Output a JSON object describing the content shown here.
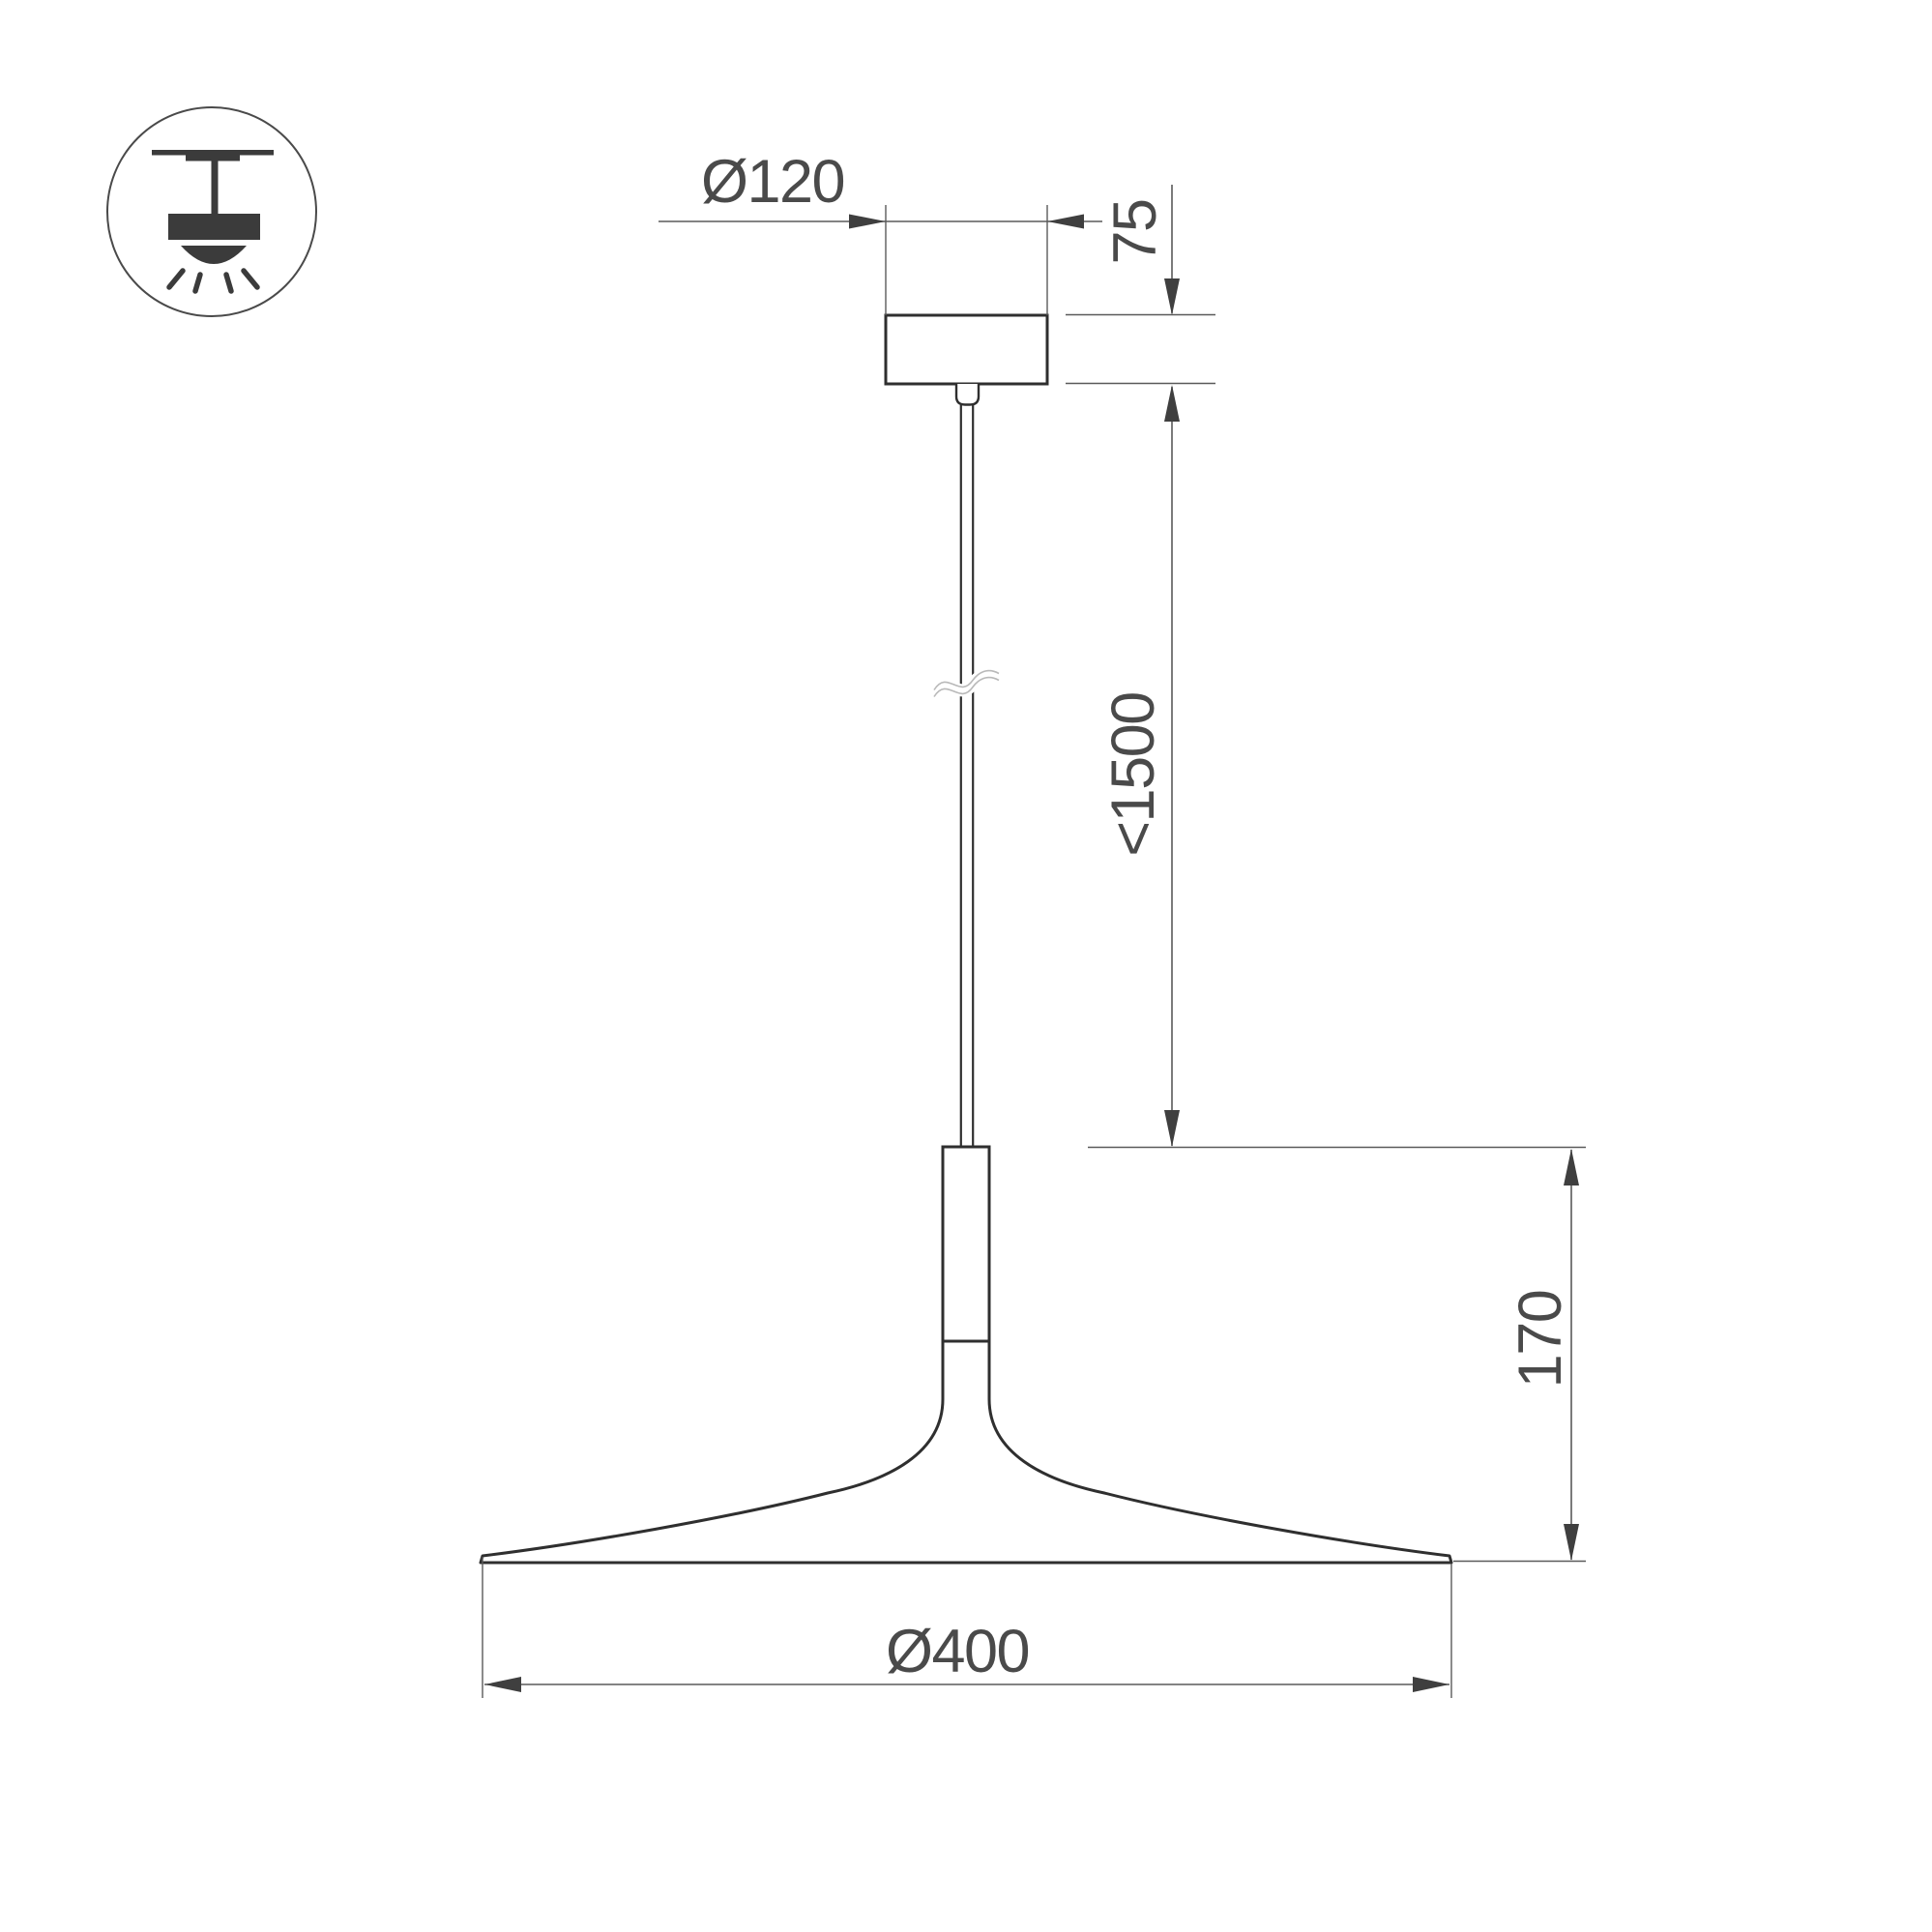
{
  "drawing": {
    "type": "pendant-lamp-dimension-drawing",
    "background": "#ffffff",
    "colors": {
      "outline": "#2f2f2f",
      "dimension_lines": "#5a5a5a",
      "dimension_text": "#4a4a4a",
      "icon": "#3b3b3b",
      "break_mark": "#b9b9b9"
    },
    "icon": {
      "name": "ceiling-pendant-light-icon"
    },
    "dimensions": {
      "canopy_diameter": {
        "label": "Ø120"
      },
      "canopy_height": {
        "label": "75"
      },
      "suspension_max_length": {
        "label": "<1500"
      },
      "fixture_height": {
        "label": "170"
      },
      "shade_diameter": {
        "label": "Ø400"
      }
    }
  }
}
